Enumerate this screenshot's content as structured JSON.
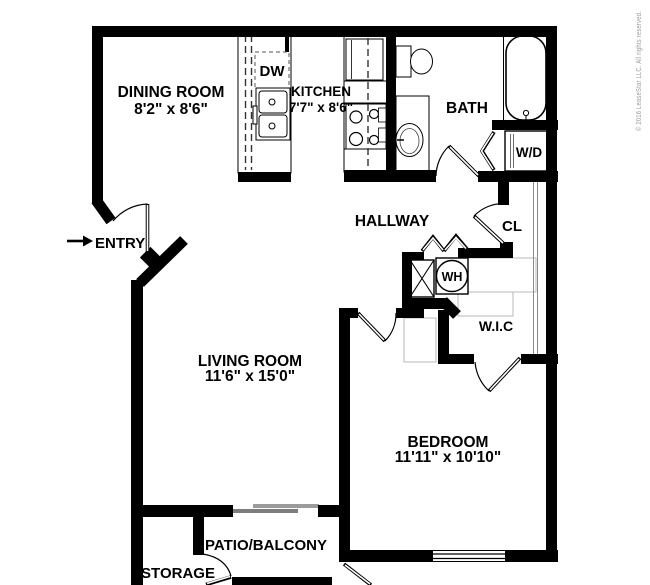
{
  "meta": {
    "copyright": "© 2016 LeaseStar LLC. All rights reserved."
  },
  "rooms": {
    "dining": {
      "name": "DINING ROOM",
      "dims": "8'2\" x 8'6\""
    },
    "kitchen": {
      "name": "KITCHEN",
      "dims": "7'7\" x 8'6\""
    },
    "bath": {
      "name": "BATH"
    },
    "hallway": {
      "name": "HALLWAY"
    },
    "closet": {
      "name": "CL"
    },
    "wic": {
      "name": "W.I.C"
    },
    "living": {
      "name": "LIVING ROOM",
      "dims": "11'6\" x 15'0\""
    },
    "bedroom": {
      "name": "BEDROOM",
      "dims": "11'11\" x 10'10\""
    },
    "entry": {
      "name": "ENTRY"
    },
    "patio": {
      "name": "PATIO/BALCONY"
    },
    "storage": {
      "name": "STORAGE"
    }
  },
  "fixtures": {
    "dishwasher": "DW",
    "washer_dryer": "W/D",
    "water_heater": "WH"
  },
  "colors": {
    "wall": "#000000",
    "shelf_gray": "#b8b8b8",
    "slider_gray": "#7d7d7d",
    "copyright_gray": "#9a9a9a"
  }
}
